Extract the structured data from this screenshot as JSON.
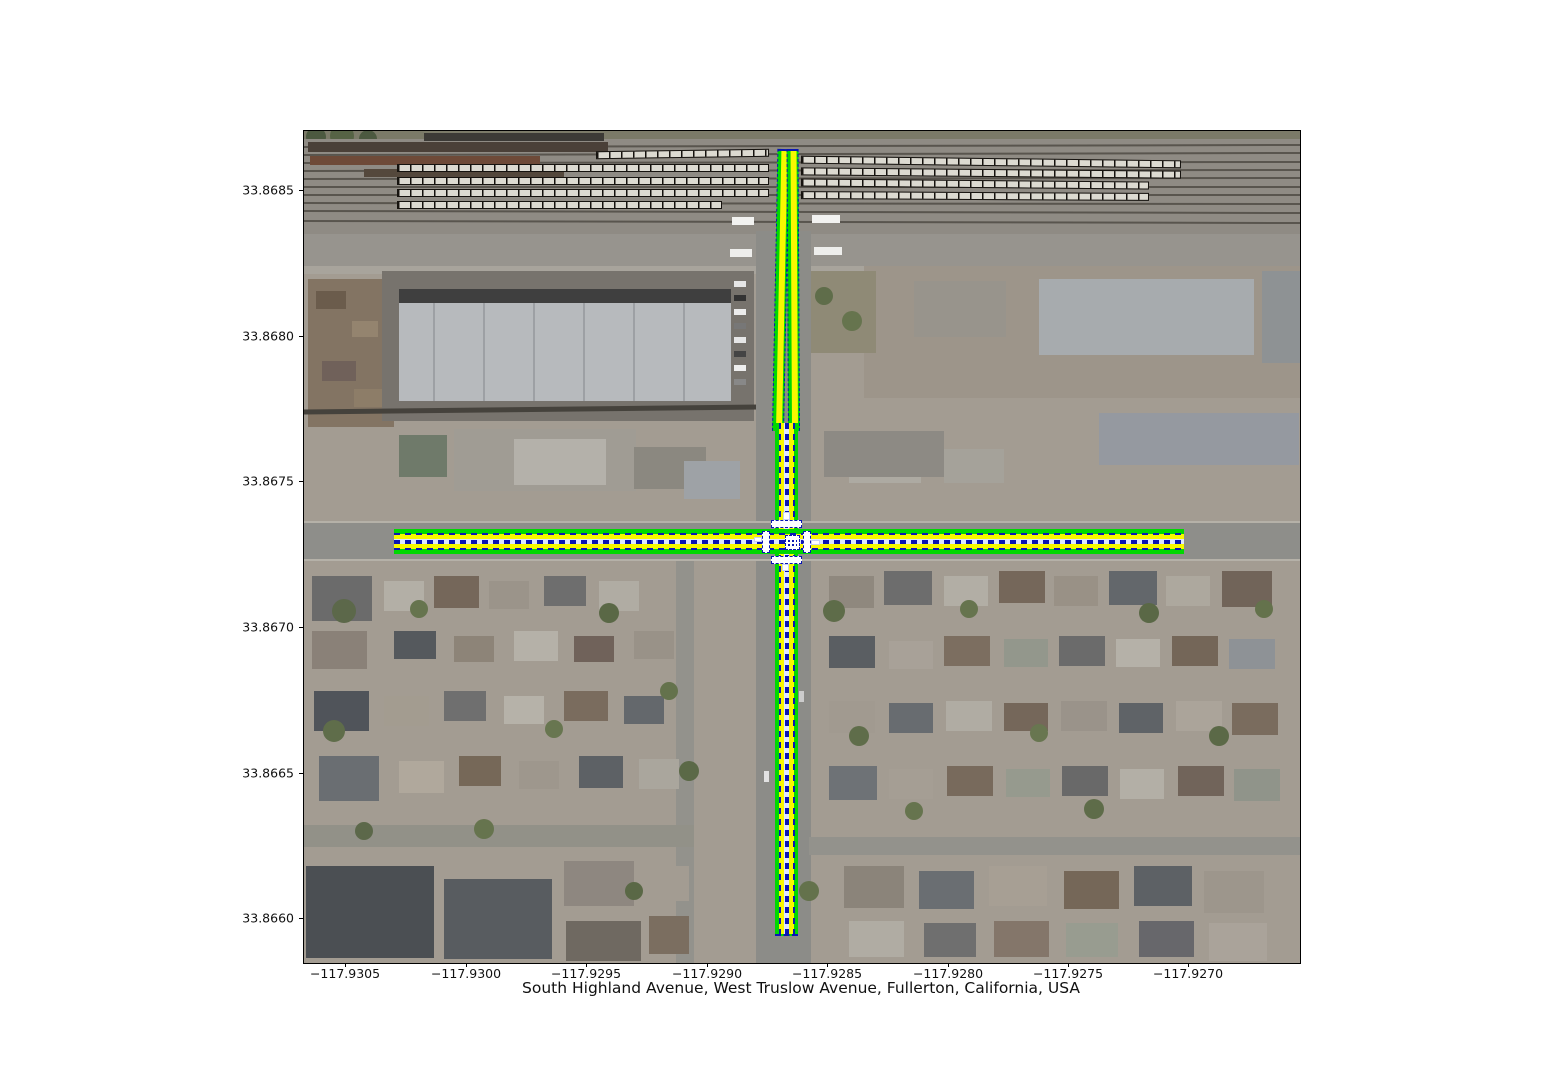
{
  "figure": {
    "title": "South Highland Avenue, West Truslow Avenue, Fullerton, California, USA",
    "y_ticks": [
      "33.8685",
      "33.8680",
      "33.8675",
      "33.8670",
      "33.8665",
      "33.8660"
    ],
    "x_ticks": [
      "−117.9305",
      "−117.9300",
      "−117.9295",
      "−117.9290",
      "−117.9285",
      "−117.9280",
      "−117.9275",
      "−117.9270"
    ]
  },
  "map_overlay": {
    "location": "Fullerton, California, USA",
    "roads": [
      {
        "name": "South Highland Avenue",
        "orientation": "vertical"
      },
      {
        "name": "West Truslow Avenue",
        "orientation": "horizontal"
      }
    ],
    "features": [
      "lane centerlines",
      "lane edges",
      "crosswalks",
      "junction box",
      "rail cars on sidings"
    ],
    "colors": {
      "lane_edge_green": "#00d800",
      "lane_fill_yellow": "#f8f800",
      "lane_divider_blue": "#0b16b4",
      "crosswalk_white": "#ffffff",
      "railcar_fill": "#dcdad1",
      "railcar_outline": "#16130f"
    }
  }
}
